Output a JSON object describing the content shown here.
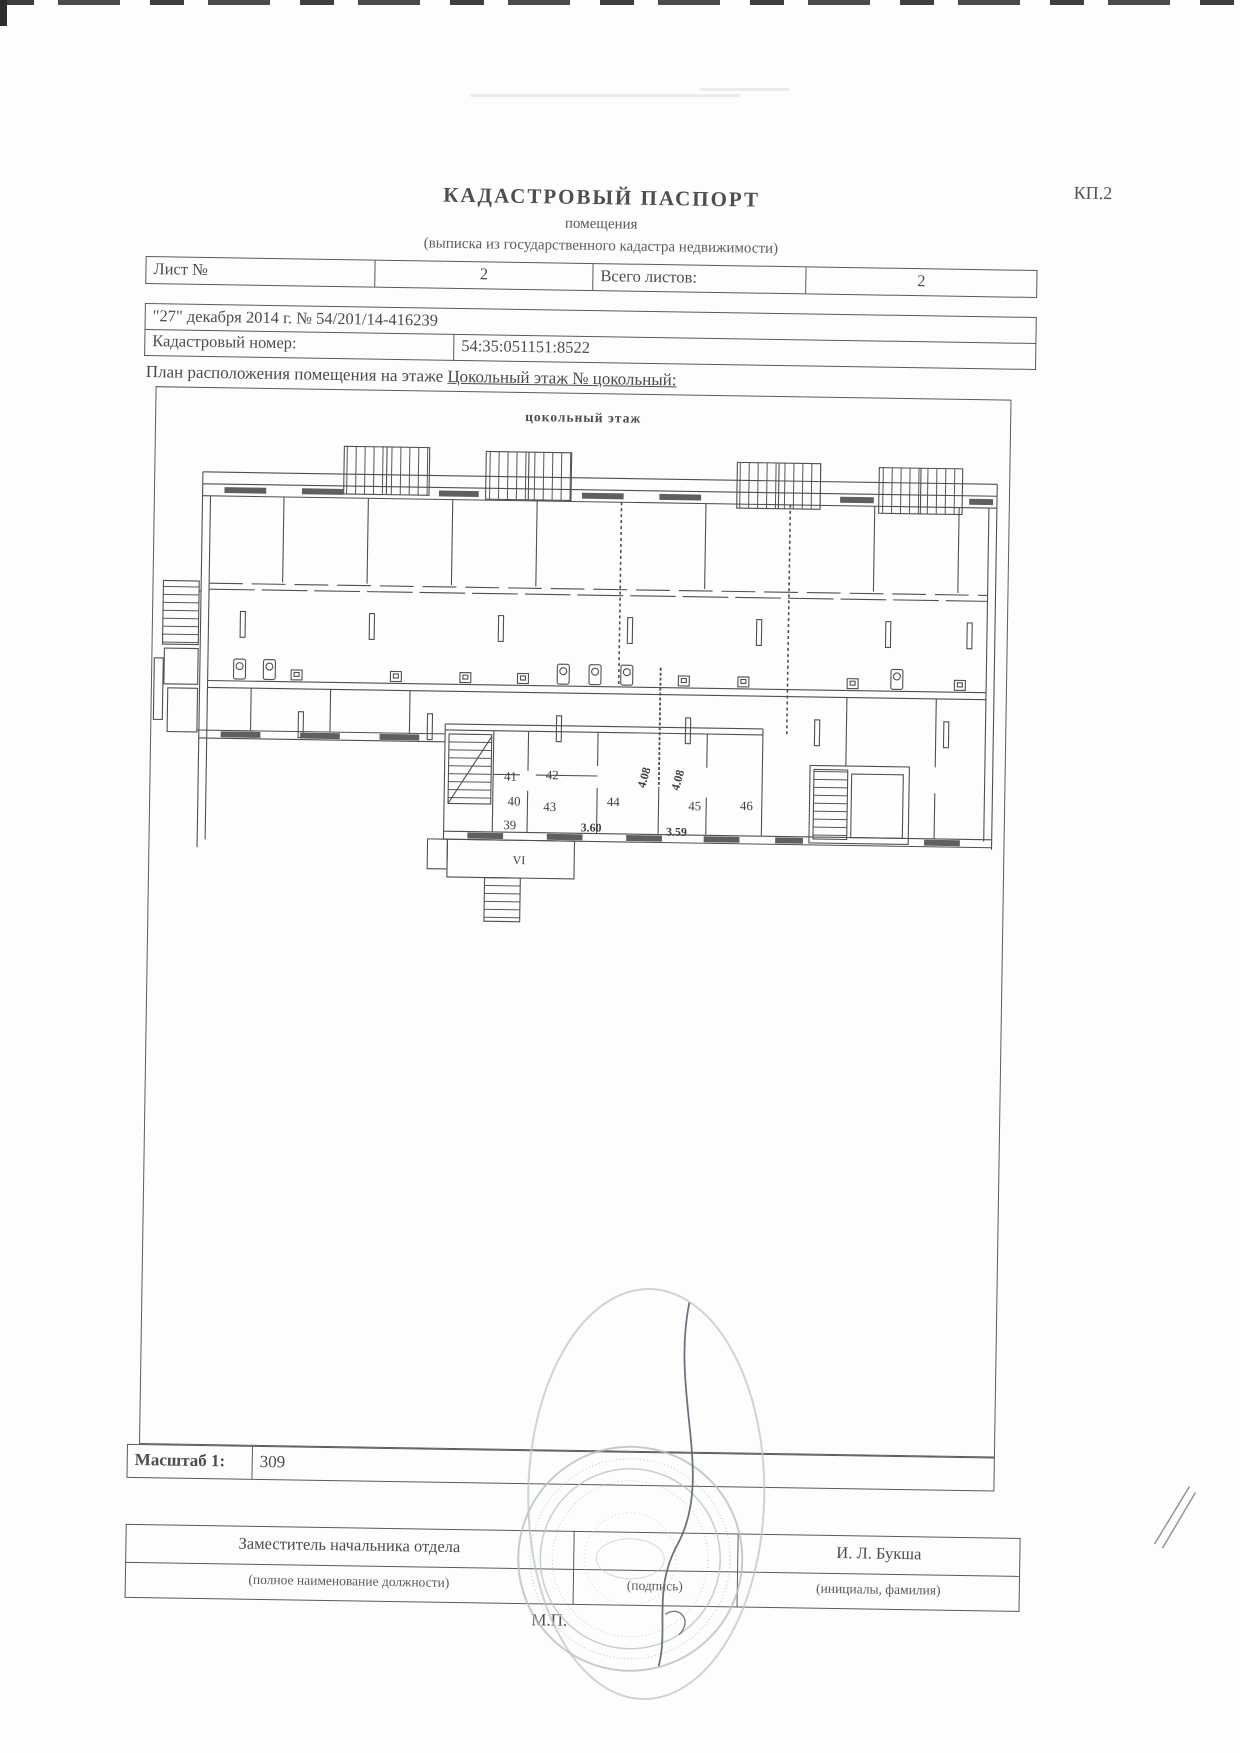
{
  "page": {
    "form_code": "КП.2"
  },
  "header": {
    "title": "КАДАСТРОВЫЙ ПАСПОРТ",
    "subtitle": "помещения",
    "subtitle2": "(выписка из государственного кадастра недвижимости)"
  },
  "sheet_table": {
    "sheet_label": "Лист №",
    "sheet_value": "2",
    "total_label": "Всего листов:",
    "total_value": "2"
  },
  "date_row": "\"27\" декабря 2014 г. № 54/201/14-416239",
  "cadastral": {
    "label": "Кадастровый номер:",
    "value": "54:35:051151:8522"
  },
  "plan_caption": {
    "prefix": "План расположения помещения на этаже ",
    "floor": "Цокольный этаж № цокольный:"
  },
  "plan": {
    "title": "цокольный этаж",
    "rooms": {
      "r39": "39",
      "r40": "40",
      "r41": "41",
      "r42": "42",
      "r43": "43",
      "r44": "44",
      "r45": "45",
      "r46": "46"
    },
    "dims": {
      "d408a": "4.08",
      "d408b": "4.08",
      "d360": "3.60",
      "d359": "3.59"
    },
    "stair_label": "VI"
  },
  "scale": {
    "label": "Масштаб 1:",
    "value": "309"
  },
  "signature": {
    "position": "Заместитель начальника отдела",
    "position_hint": "(полное наименование должности)",
    "sign_hint": "(подпись)",
    "name": "И. Л. Букша",
    "name_hint": "(инициалы, фамилия)",
    "stamp_hint": "М.П."
  }
}
